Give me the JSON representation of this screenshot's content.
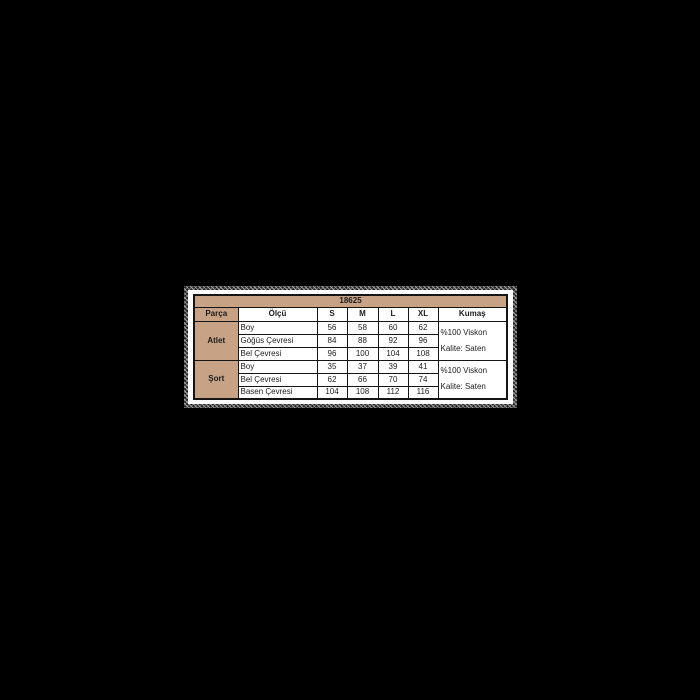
{
  "page": {
    "background": "#000000"
  },
  "size_chart": {
    "product_code": "18625",
    "columns": {
      "part": "Parça",
      "measure": "Ölçü",
      "sizes": [
        "S",
        "M",
        "L",
        "XL"
      ],
      "fabric": "Kumaş"
    },
    "sections": [
      {
        "name": "Atlet",
        "rows": [
          {
            "label": "Boy",
            "values": [
              "56",
              "58",
              "60",
              "62"
            ]
          },
          {
            "label": "Göğüs Çevresi",
            "values": [
              "84",
              "88",
              "92",
              "96"
            ]
          },
          {
            "label": "Bel Çevresi",
            "values": [
              "96",
              "100",
              "104",
              "108"
            ]
          }
        ],
        "fabric_lines": [
          "%100 Viskon",
          "Kalite: Saten"
        ]
      },
      {
        "name": "Şort",
        "rows": [
          {
            "label": "Boy",
            "values": [
              "35",
              "37",
              "39",
              "41"
            ]
          },
          {
            "label": "Bel Çevresi",
            "values": [
              "62",
              "66",
              "70",
              "74"
            ]
          },
          {
            "label": "Basen Çevresi",
            "values": [
              "104",
              "108",
              "112",
              "116"
            ]
          }
        ],
        "fabric_lines": [
          "%100 Viskon",
          "Kalite: Saten"
        ]
      }
    ],
    "colors": {
      "tan": "#c7a284",
      "border": "#151515",
      "cell_bg": "#ffffff",
      "text": "#1c1c1c",
      "page_bg": "#000000"
    }
  }
}
